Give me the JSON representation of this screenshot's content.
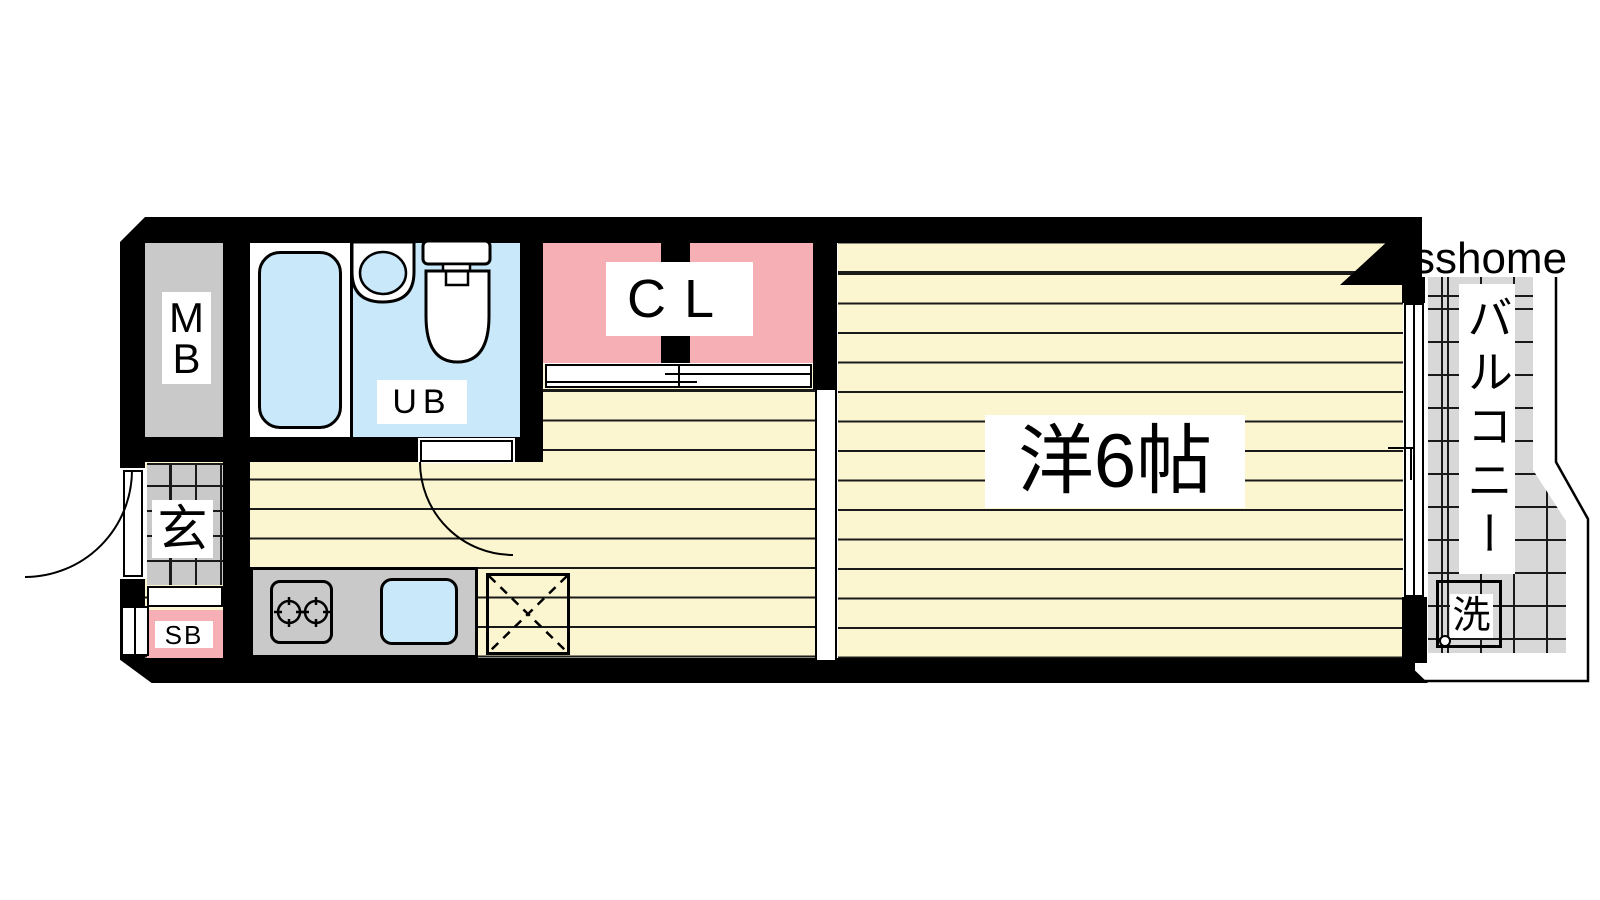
{
  "labels": {
    "mb": "MB",
    "ub": "UB",
    "cl": "CL",
    "genkan": "玄",
    "sb": "SB",
    "room": "洋6帖",
    "balcony": "バルコニー",
    "washer": "洗",
    "watermark": "sshome"
  },
  "colors": {
    "floor": "#FCF6D0",
    "pink": "#F5AFB5",
    "blue": "#C9E8F9",
    "gray": "#C9C9C9",
    "balcony_gray": "#D8D8D8",
    "wall": "#000000",
    "stripe": "#1a1a1a"
  }
}
